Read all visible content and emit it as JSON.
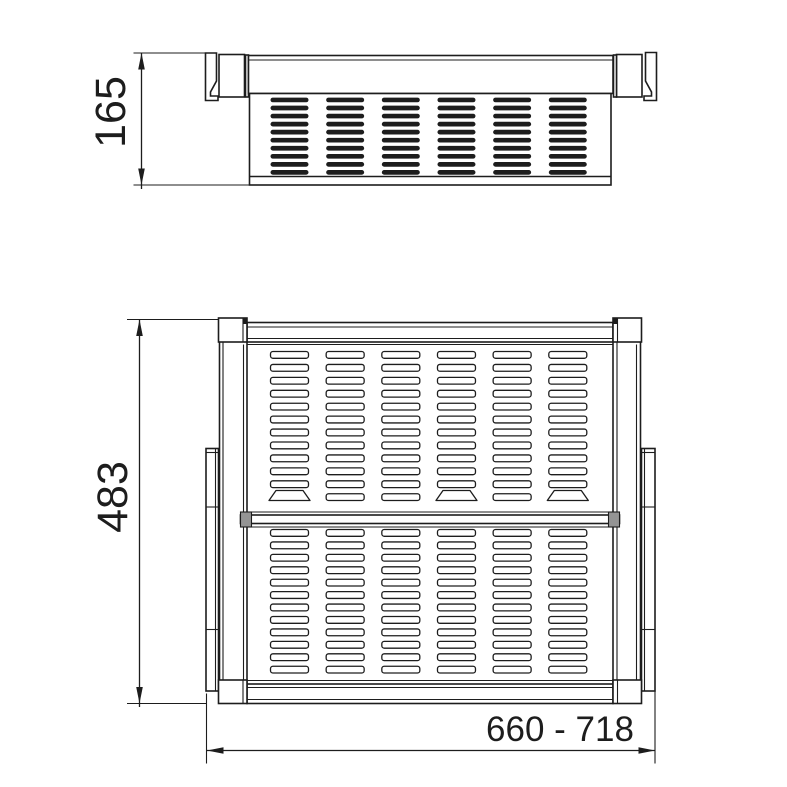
{
  "drawing": {
    "type": "technical-dimension-drawing",
    "background": "#ffffff",
    "line_color": "#1d1d1d",
    "divider_cap_color": "#949494",
    "views": [
      {
        "id": "front",
        "name": "front-elevation"
      },
      {
        "id": "plan",
        "name": "plan-top-view"
      }
    ]
  },
  "dimensions": {
    "front_height": "165",
    "plan_depth": "483",
    "width_range": "660 - 718"
  },
  "front_view": {
    "slot_columns": 6,
    "slot_rows": 10
  },
  "plan_view": {
    "slot_columns": 6,
    "upper_slot_rows": 12,
    "lower_slot_rows": 12,
    "trapezoid_slot_columns": [
      1,
      4,
      6
    ]
  }
}
